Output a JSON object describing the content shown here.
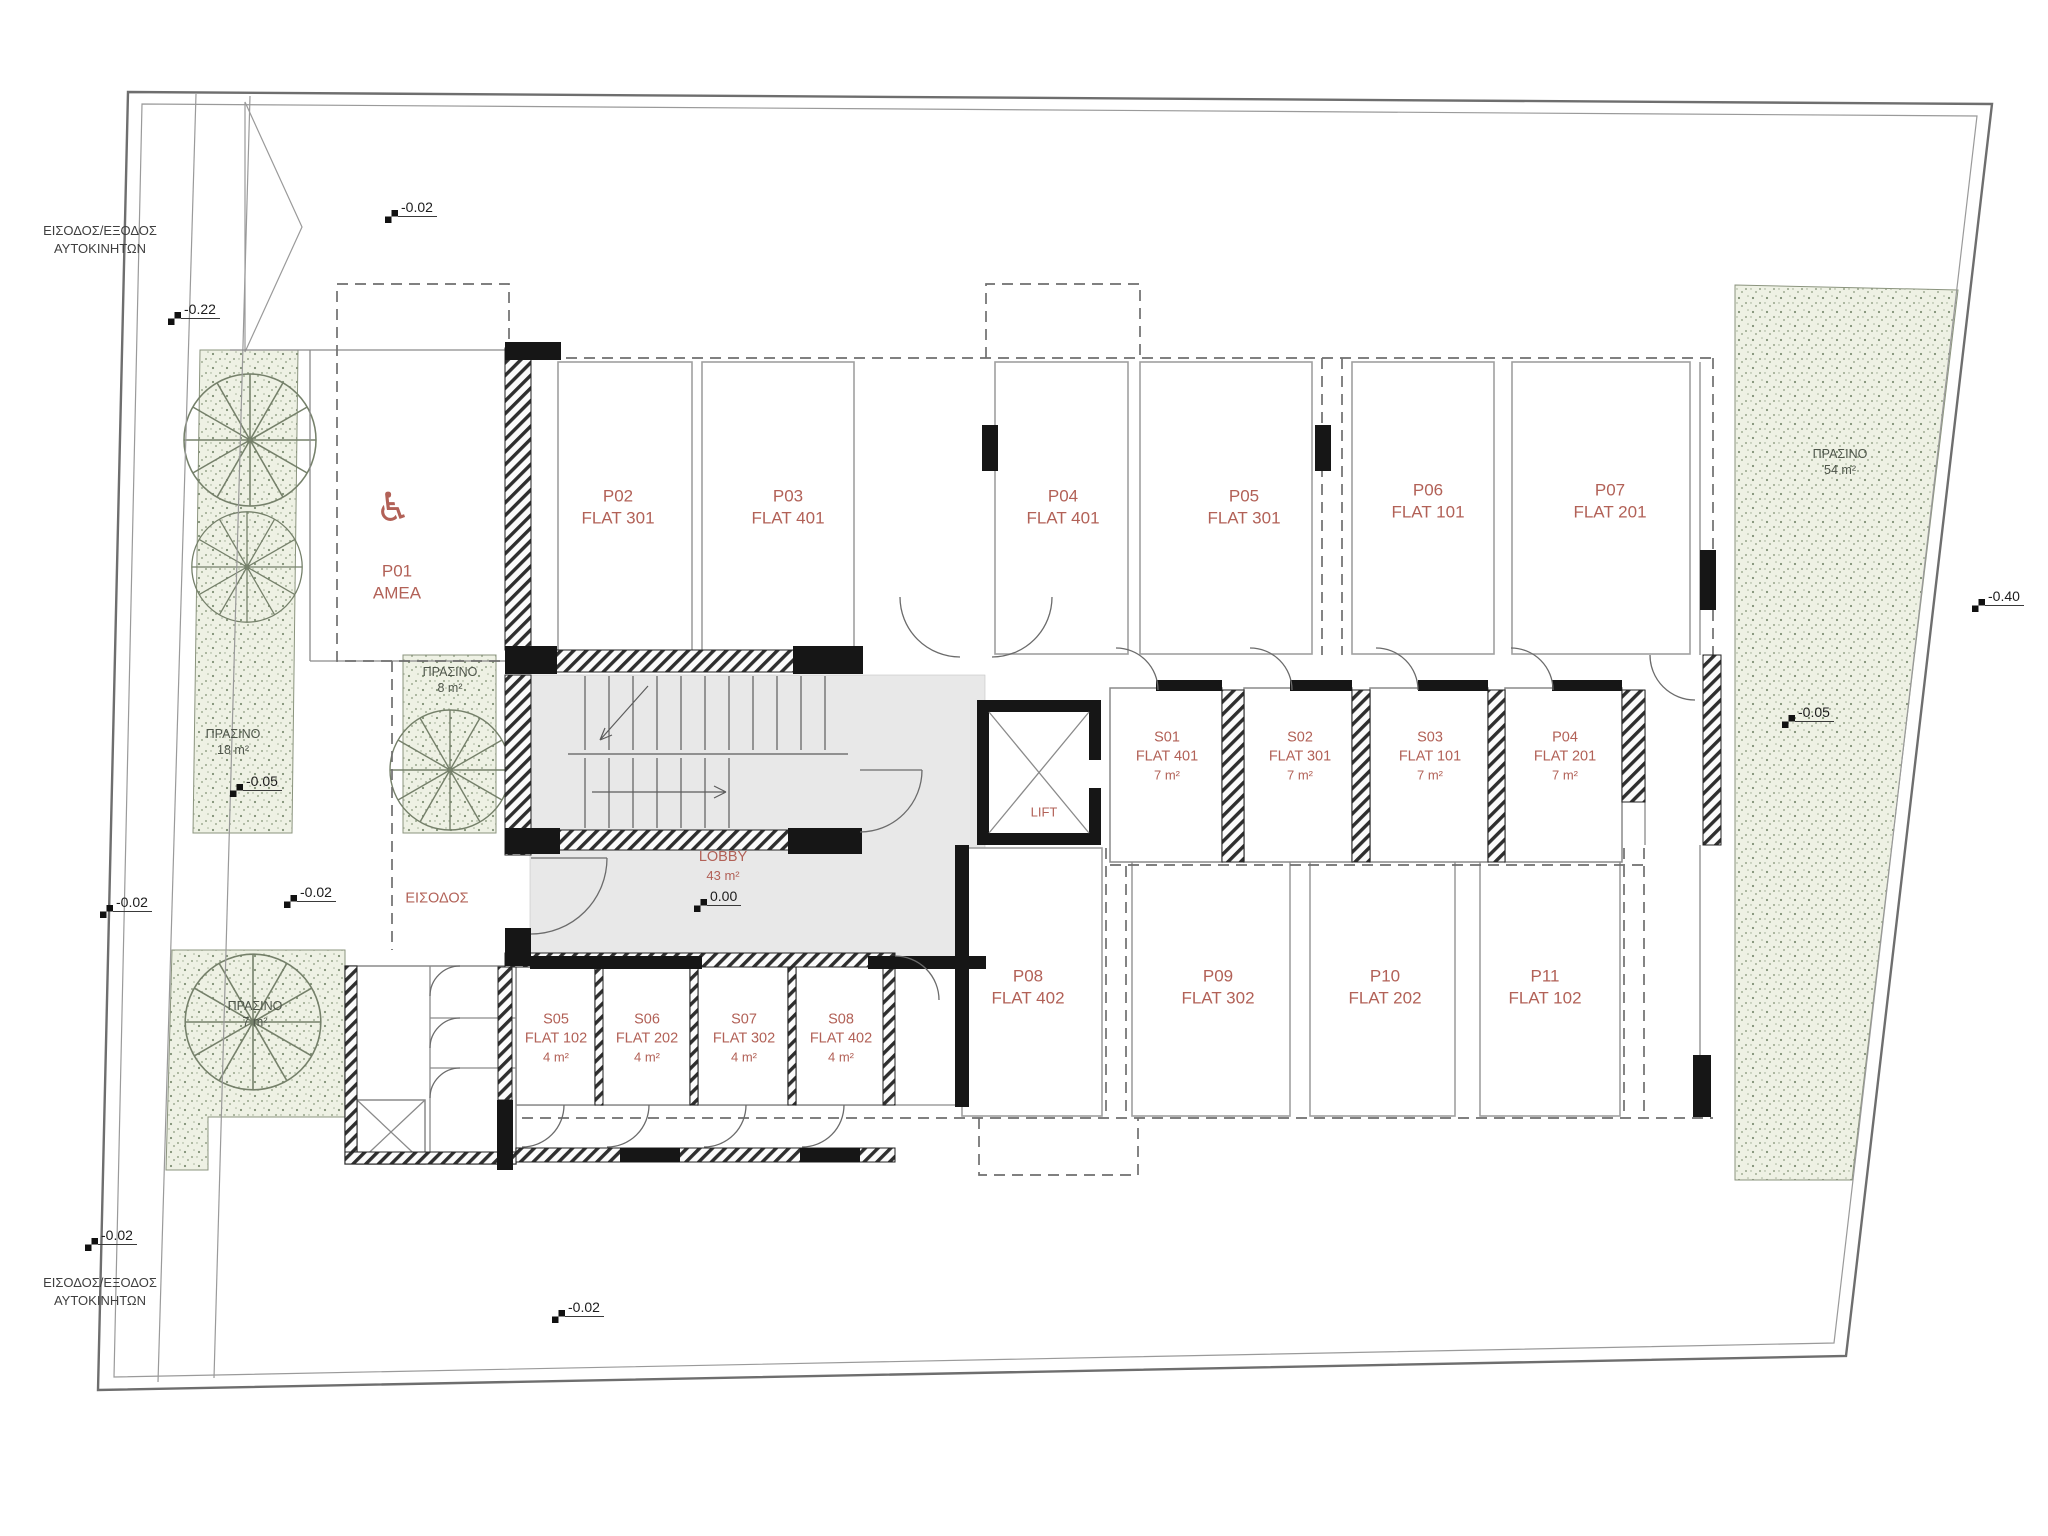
{
  "colors": {
    "label_red": "#b26157",
    "green_fill": "#eef1e4",
    "wall_black": "#161616",
    "floor_gray": "#e8e8e8"
  },
  "icons": {
    "wheelchair": "♿"
  },
  "site": {
    "car_access_top": {
      "line1": "ΕΙΣΟΔΟΣ/ΕΞΟΔΟΣ",
      "line2": "ΑΥΤΟΚΙΝΗΤΩΝ"
    },
    "car_access_bottom": {
      "line1": "ΕΙΣΟΔΟΣ/ΕΞΟΔΟΣ",
      "line2": "ΑΥΤΟΚΙΝΗΤΩΝ"
    }
  },
  "levels": {
    "top": "-0.02",
    "upper_left": "-0.22",
    "left_green": "-0.05",
    "left_mid": "-0.02",
    "entrance_court": "-0.02",
    "lobby": "0.00",
    "bottom_left": "-0.02",
    "bottom_center": "-0.02",
    "right_outside": "-0.40",
    "right_green": "-0.05"
  },
  "parking": {
    "p01": {
      "code": "P01",
      "flat": "ΑΜΕΑ"
    },
    "p02": {
      "code": "P02",
      "flat": "FLAT 301"
    },
    "p03": {
      "code": "P03",
      "flat": "FLAT 401"
    },
    "p04": {
      "code": "P04",
      "flat": "FLAT 401"
    },
    "p05": {
      "code": "P05",
      "flat": "FLAT 301"
    },
    "p06": {
      "code": "P06",
      "flat": "FLAT 101"
    },
    "p07": {
      "code": "P07",
      "flat": "FLAT 201"
    },
    "p08": {
      "code": "P08",
      "flat": "FLAT 402"
    },
    "p09": {
      "code": "P09",
      "flat": "FLAT 302"
    },
    "p10": {
      "code": "P10",
      "flat": "FLAT 202"
    },
    "p11": {
      "code": "P11",
      "flat": "FLAT 102"
    }
  },
  "storage": {
    "s01": {
      "code": "S01",
      "flat": "FLAT 401",
      "area": "7 m²"
    },
    "s02": {
      "code": "S02",
      "flat": "FLAT 301",
      "area": "7 m²"
    },
    "s03": {
      "code": "S03",
      "flat": "FLAT 101",
      "area": "7 m²"
    },
    "s04": {
      "code": "P04",
      "flat": "FLAT 201",
      "area": "7 m²"
    },
    "s05": {
      "code": "S05",
      "flat": "FLAT 102",
      "area": "4 m²"
    },
    "s06": {
      "code": "S06",
      "flat": "FLAT 202",
      "area": "4 m²"
    },
    "s07": {
      "code": "S07",
      "flat": "FLAT 302",
      "area": "4 m²"
    },
    "s08": {
      "code": "S08",
      "flat": "FLAT 402",
      "area": "4 m²"
    }
  },
  "rooms": {
    "lobby": {
      "name": "LOBBY",
      "area": "43 m²"
    },
    "lift": {
      "name": "LIFT"
    },
    "entrance": {
      "name": "ΕΙΣΟΔΟΣ"
    }
  },
  "green": {
    "right": {
      "name": "ΠΡΑΣΙΝΟ",
      "area": "54 m²"
    },
    "left": {
      "name": "ΠΡΑΣΙΝΟ",
      "area": "18 m²"
    },
    "middle": {
      "name": "ΠΡΑΣΙΝΟ",
      "area": "8 m²"
    },
    "bottom_left": {
      "name": "ΠΡΑΣΙΝΟ",
      "area": "7 m²"
    }
  }
}
